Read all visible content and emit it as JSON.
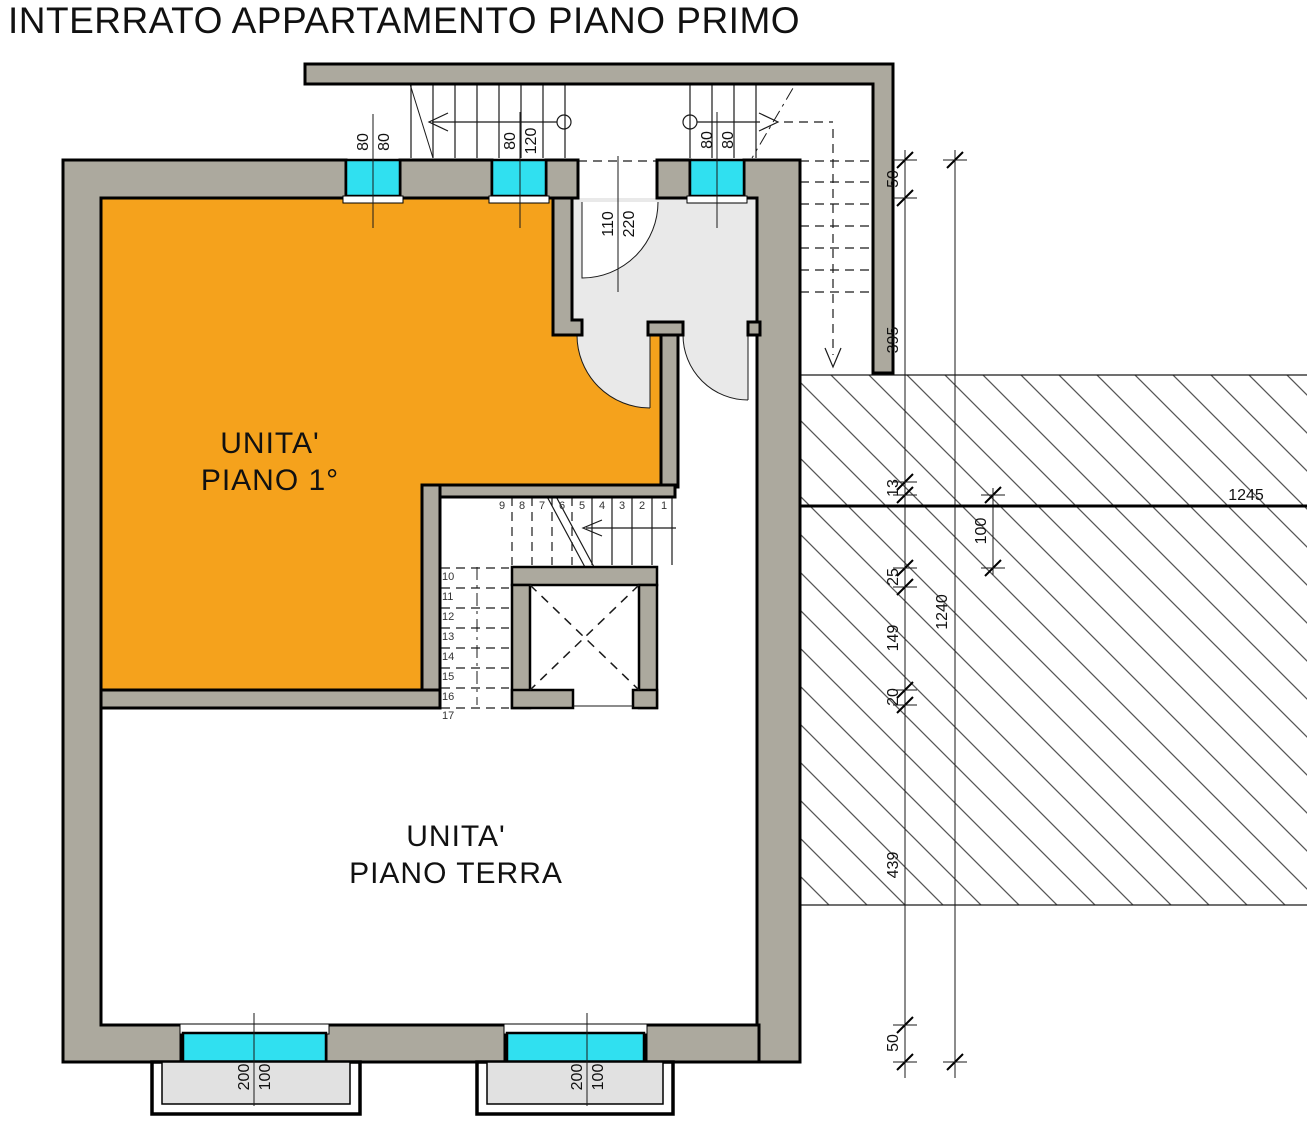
{
  "title": "INTERRATO APPARTAMENTO PIANO PRIMO",
  "units": {
    "first_floor": {
      "line1": "UNITA'",
      "line2": "PIANO 1°"
    },
    "ground_floor": {
      "line1": "UNITA'",
      "line2": "PIANO TERRA"
    }
  },
  "openings": {
    "top_window_1": {
      "width": "80",
      "height": "80"
    },
    "top_window_2": {
      "width": "80",
      "height": "120"
    },
    "entrance_door": {
      "width": "110",
      "height": "220"
    },
    "top_window_3": {
      "width": "80",
      "height": "80"
    },
    "bottom_window_1": {
      "width": "200",
      "height": "100"
    },
    "bottom_window_2": {
      "width": "200",
      "height": "100"
    }
  },
  "site_dimensions": {
    "top_offset": "50",
    "stairwell_depth": "395",
    "ledge": "13",
    "landing_width": "100",
    "gap_25": "25",
    "seg_149": "149",
    "seg_20": "20",
    "seg_439": "439",
    "bottom_offset": "50",
    "total_height": "1240",
    "total_width": "1245"
  },
  "stairs": {
    "upper_flight": [
      "9",
      "8",
      "7",
      "6",
      "5",
      "4",
      "3",
      "2",
      "1"
    ],
    "lower_flight": [
      "10",
      "11",
      "12",
      "13",
      "14",
      "15",
      "16",
      "17"
    ]
  },
  "colors": {
    "unit_first_floor_fill": "#F5A21C",
    "window_fill": "#30E0F0",
    "wall_fill": "#ACA99E",
    "vestibule_fill": "#E9E9E9",
    "hatch_line": "#565656"
  }
}
